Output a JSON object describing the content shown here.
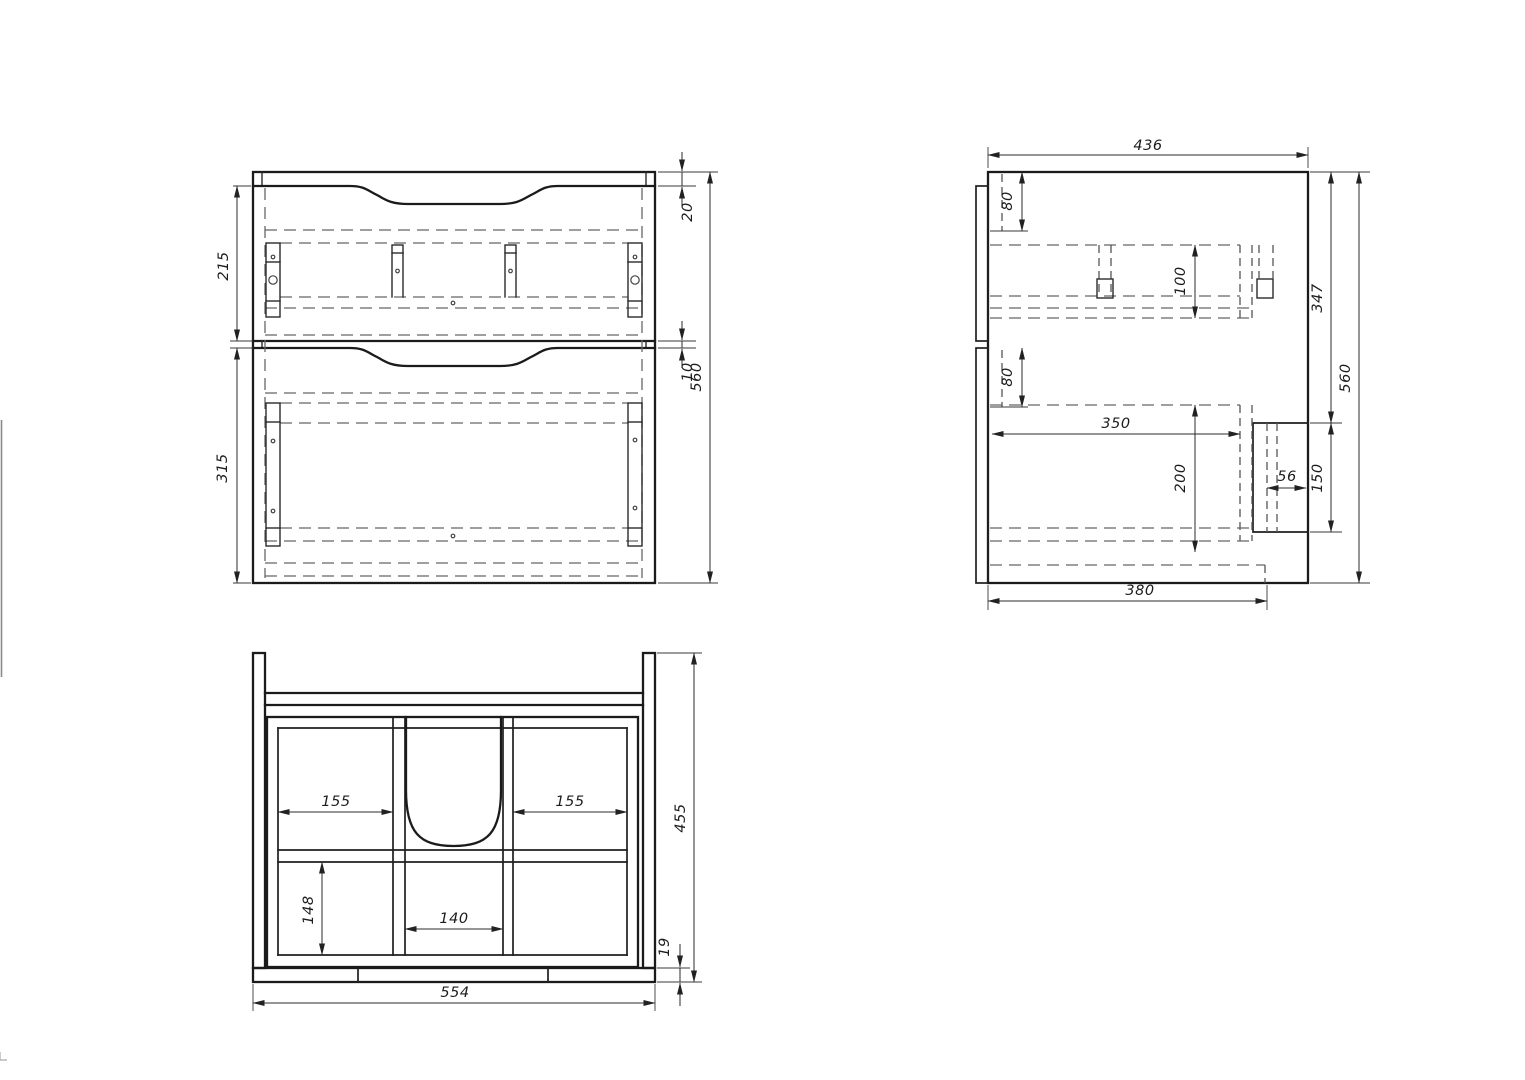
{
  "front_view": {
    "dim_drawer1_height": "215",
    "dim_drawer2_height": "315",
    "dim_top_reveal": "20",
    "dim_drawer_gap": "10",
    "dim_total_height": "560"
  },
  "side_view": {
    "dim_depth": "436",
    "dim_top_rail_offset": "80",
    "dim_rail_band_height": "100",
    "dim_upper_section": "347",
    "dim_total_height": "560",
    "dim_mid_rail_offset": "80",
    "dim_inner_depth": "350",
    "dim_drawer_side_height": "200",
    "dim_notch_depth": "56",
    "dim_notch_height": "150",
    "dim_bottom_depth": "380"
  },
  "bottom_view": {
    "dim_left_cell_width": "155",
    "dim_right_cell_width": "155",
    "dim_total_depth": "455",
    "dim_rear_cell_depth": "148",
    "dim_center_cell_width": "140",
    "dim_front_panel_thickness": "19",
    "dim_total_width": "554"
  }
}
